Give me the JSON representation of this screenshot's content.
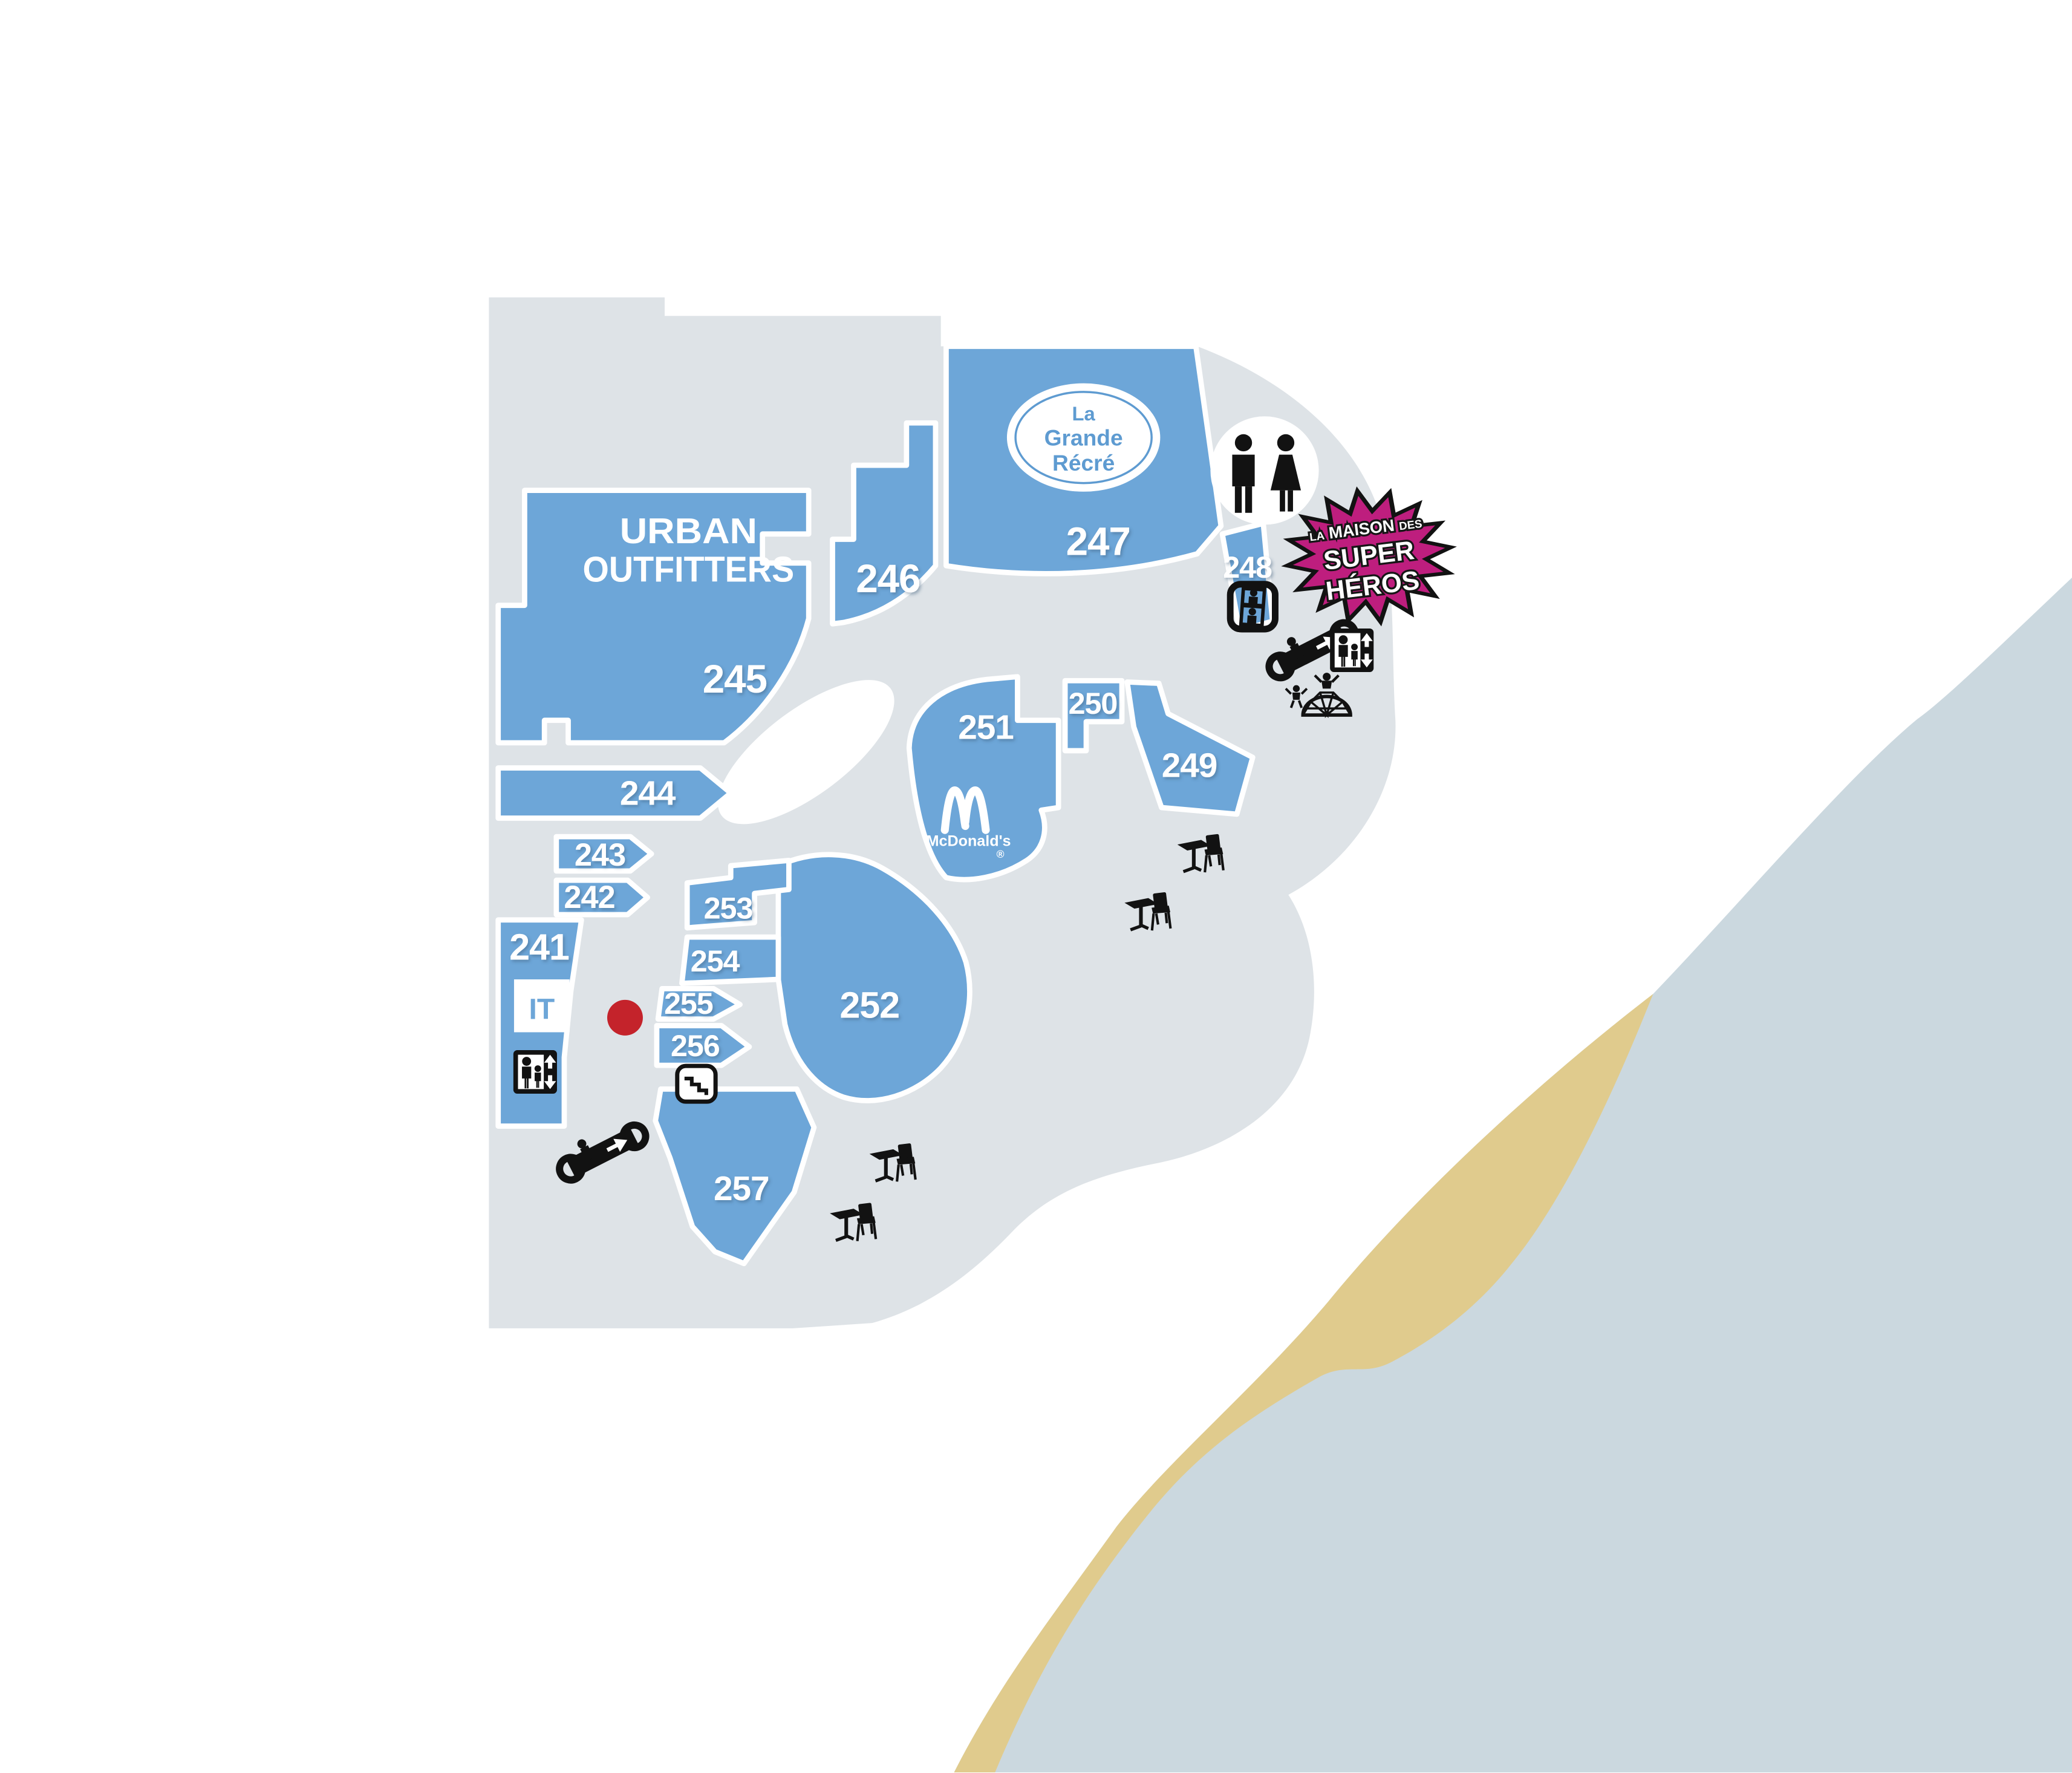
{
  "map": {
    "stores": {
      "241": {
        "number": "241",
        "tenant": "IT"
      },
      "242": {
        "number": "242"
      },
      "243": {
        "number": "243"
      },
      "244": {
        "number": "244"
      },
      "245": {
        "number": "245",
        "tenant": "Urban Outfitters"
      },
      "246": {
        "number": "246"
      },
      "247": {
        "number": "247",
        "tenant": "La Grande Récré"
      },
      "248": {
        "number": "248"
      },
      "249": {
        "number": "249"
      },
      "250": {
        "number": "250"
      },
      "251": {
        "number": "251",
        "tenant": "McDonald's"
      },
      "252": {
        "number": "252"
      },
      "253": {
        "number": "253"
      },
      "254": {
        "number": "254"
      },
      "255": {
        "number": "255"
      },
      "256": {
        "number": "256"
      },
      "257": {
        "number": "257"
      }
    },
    "logos": {
      "urban_outfitters": {
        "line1": "URBAN",
        "line2": "OUTFITTERS"
      },
      "la_grande_recre": {
        "line1": "La",
        "line2": "Grande",
        "line3": "Récré"
      },
      "mcdonalds": {
        "name": "McDonald's",
        "registered": "®"
      },
      "it": {
        "text": "IT"
      }
    },
    "badge": {
      "prefix": "LA",
      "main": "MAISON",
      "suffix": "DES",
      "line2": "SUPER",
      "line3": "HÉROS"
    },
    "icons": {
      "restroom": "men-women-restroom",
      "elevator": "elevator-with-up-down-arrows",
      "panoramic_lift": "glass-elevator",
      "escalator": "escalator-up",
      "stairs": "staircase",
      "playground": "kids-climbing-dome",
      "cafe": "table-and-chair",
      "you_are_here": "red-dot"
    },
    "colors": {
      "store_blue": "#6DA6D8",
      "floor_gray": "#DEE3E7",
      "exterior_bluegray": "#CBD8DF",
      "path_beige": "#E0CB8D",
      "badge_magenta": "#BE1E7E",
      "dot_red": "#C4232B",
      "icon_black": "#121212",
      "white": "#FFFFFF",
      "logo_blue": "#5E9BD1"
    }
  }
}
